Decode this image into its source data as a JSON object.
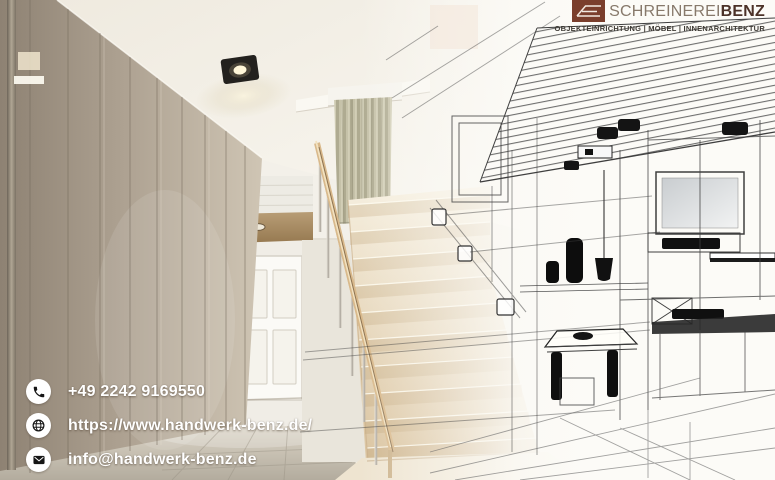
{
  "brand": {
    "name_regular": "SCHREINEREI",
    "name_bold": "BENZ",
    "tagline": "OBJEKTEINRICHTUNG | MÖBEL | INNENARCHITEKTUR"
  },
  "contact": {
    "phone": "+49 2242 9169550",
    "website": "https://www.handwerk-benz.de/",
    "email": "info@handwerk-benz.de"
  },
  "colors": {
    "logo_square_brown": "#7a3e2c",
    "logo_name_gray": "#87796b",
    "logo_name_dark_brown": "#4c3228",
    "tagline_text": "#3e3a34",
    "contact_text": "#ffffff",
    "wood_tread": "#e9d7b8",
    "wardrobe_taupe": "#b4a897",
    "wireframe_line": "#3f3f3f"
  }
}
